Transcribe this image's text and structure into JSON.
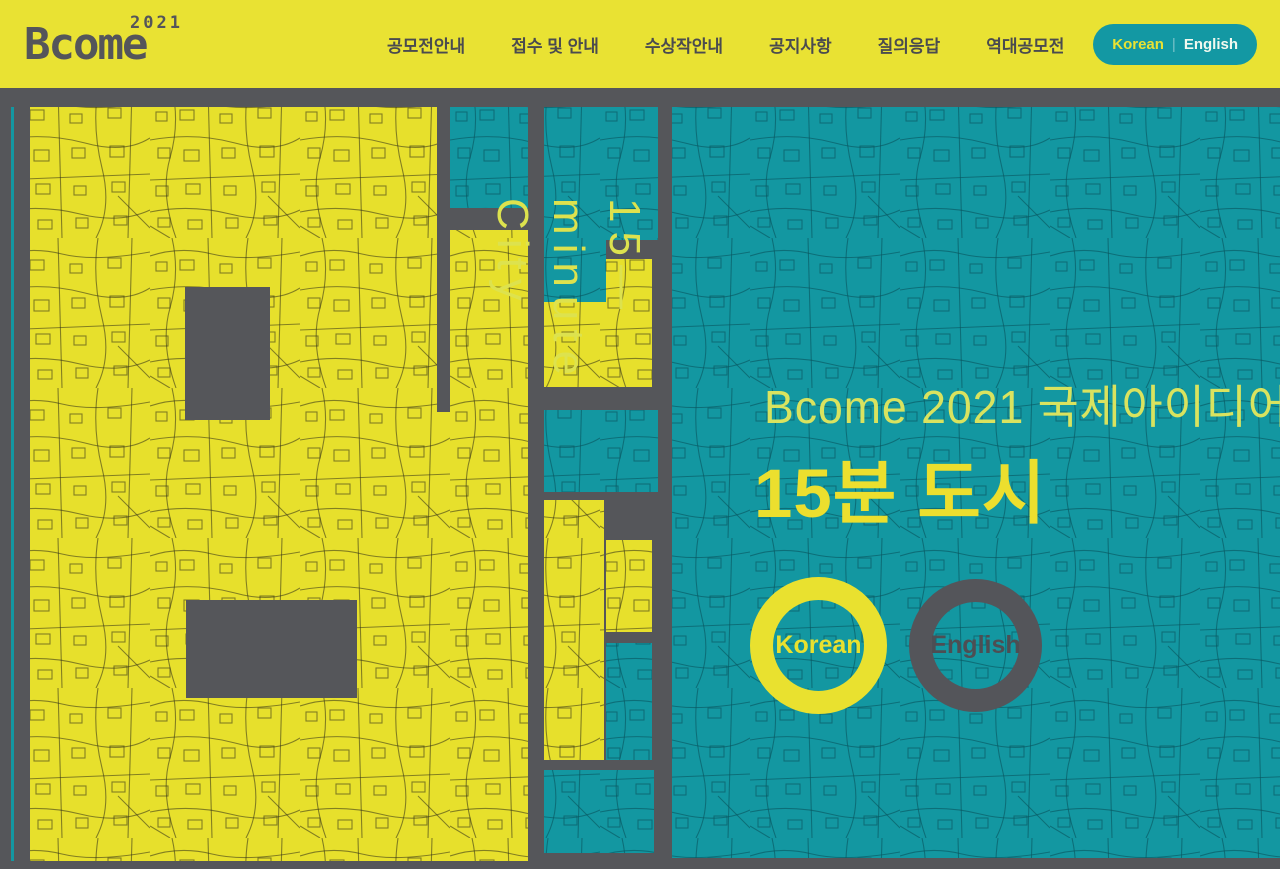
{
  "header": {
    "logo": {
      "name": "Bcome",
      "year": "2021"
    },
    "nav": [
      {
        "label": "공모전안내"
      },
      {
        "label": "접수 및 안내"
      },
      {
        "label": "수상작안내"
      },
      {
        "label": "공지사항"
      },
      {
        "label": "질의응답"
      },
      {
        "label": "역대공모전"
      }
    ],
    "lang_button": {
      "korean": "Korean",
      "separator": "|",
      "english": "English"
    }
  },
  "hero": {
    "vertical_text": {
      "line1": "15—",
      "line2": "minute",
      "line3": "City"
    },
    "title_line1": "Bcome 2021 국제아이디어공모전",
    "title_line2": "15분 도시",
    "lang_rings": [
      {
        "label": "Korean"
      },
      {
        "label": "English"
      }
    ]
  },
  "colors": {
    "header_yellow": "#e9e233",
    "map_yellow": "#e7e02c",
    "teal": "#1397a1",
    "background_gray": "#55565a",
    "title_pale_yellow": "#d9e35f",
    "title_bold_yellow": "#ecdf2e",
    "text_dark_gray": "#4a4b4f"
  }
}
